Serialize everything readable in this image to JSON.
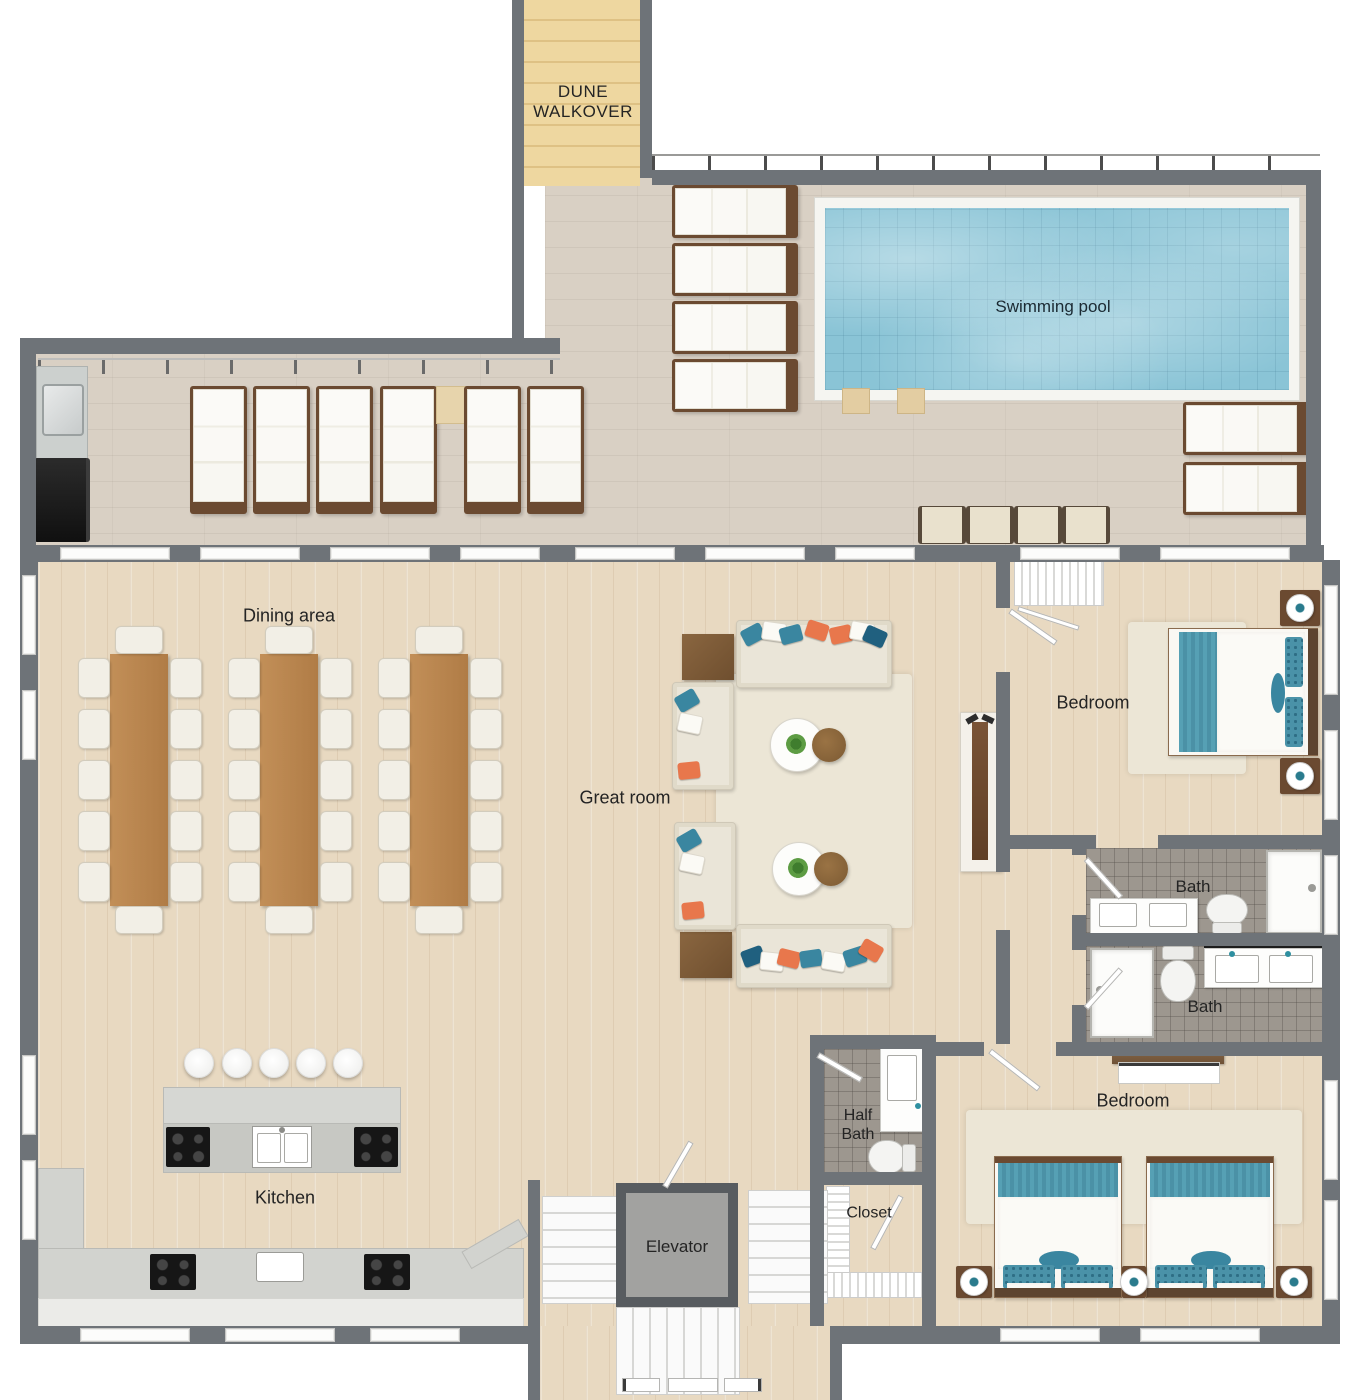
{
  "rooms": {
    "dune_walkover": {
      "label": "DUNE WALKOVER"
    },
    "swimming_pool": {
      "label": "Swimming pool"
    },
    "dining_area": {
      "label": "Dining area"
    },
    "great_room": {
      "label": "Great room"
    },
    "bedroom_top": {
      "label": "Bedroom"
    },
    "bath_top": {
      "label": "Bath"
    },
    "bath_bottom": {
      "label": "Bath"
    },
    "bedroom_bottom": {
      "label": "Bedroom"
    },
    "half_bath": {
      "label": "Half Bath"
    },
    "closet": {
      "label": "Closet"
    },
    "kitchen": {
      "label": "Kitchen"
    },
    "elevator": {
      "label": "Elevator"
    }
  },
  "inventory": {
    "dining_tables": 3,
    "chairs_per_dining_table": 12,
    "sofas": 4,
    "coffee_table_groups": 2,
    "side_tables": 2,
    "pool_loungers": 12,
    "poolside_wall_chairs": 4,
    "beds": 3,
    "nightstands": 5,
    "full_baths": 2,
    "half_baths": 1,
    "showers": 3,
    "toilets": 3,
    "cooktops": 4,
    "kitchen_sinks": 3,
    "island_pendants": 5,
    "staircases": 3
  },
  "colors": {
    "wall": "#6e7378",
    "wall_dark": "#585c60",
    "floor_wood": "#e8d9c1",
    "deck_stone": "#d9d0c4",
    "walkover_wood": "#eed7a0",
    "pool_water": "#8ac4d6",
    "pool_tile": "#f5f5f1",
    "tile_gray": "#9d978f",
    "table_wood": "#c28f58",
    "chair_cream": "#f2efe6",
    "sofa_cream": "#eae5d8",
    "rug_cream": "#ece6d6",
    "accent_teal": "#3a86a0",
    "accent_orange": "#e8774c",
    "accent_navy": "#20607f",
    "bed_blanket_teal": "#56a0b4",
    "frame_brown": "#6b4a31",
    "label_text": "#242424"
  }
}
